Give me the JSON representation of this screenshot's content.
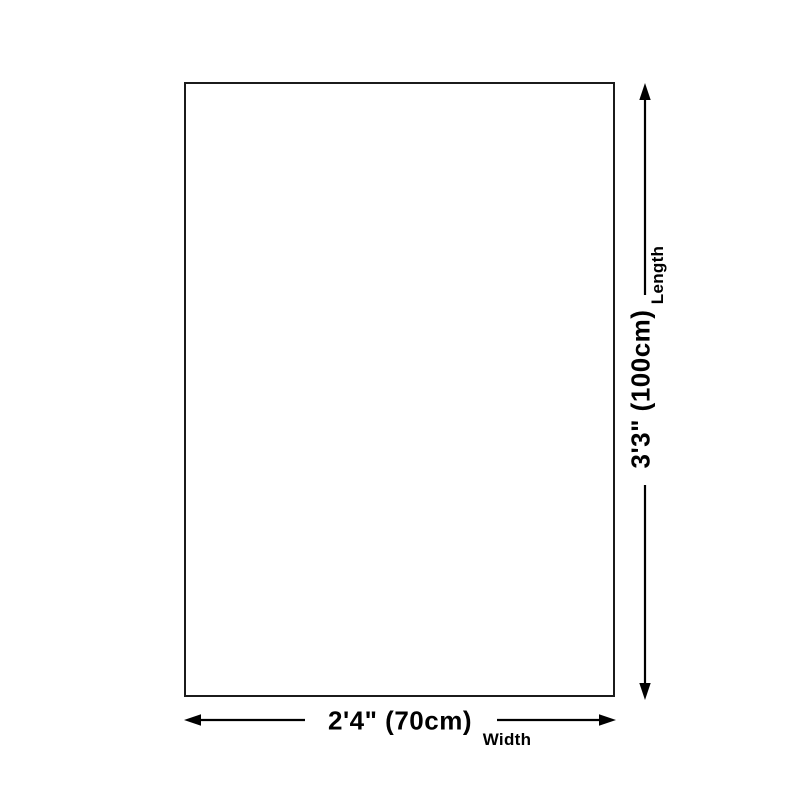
{
  "page": {
    "background_color": "#ffffff",
    "line_color": "#000000",
    "rect_border_color": "#1b1b1b"
  },
  "dimensions": {
    "length": {
      "value": "3'3\" (100cm)",
      "label": "Length"
    },
    "width": {
      "value": "2'4\" (70cm)",
      "label": "Width"
    }
  }
}
